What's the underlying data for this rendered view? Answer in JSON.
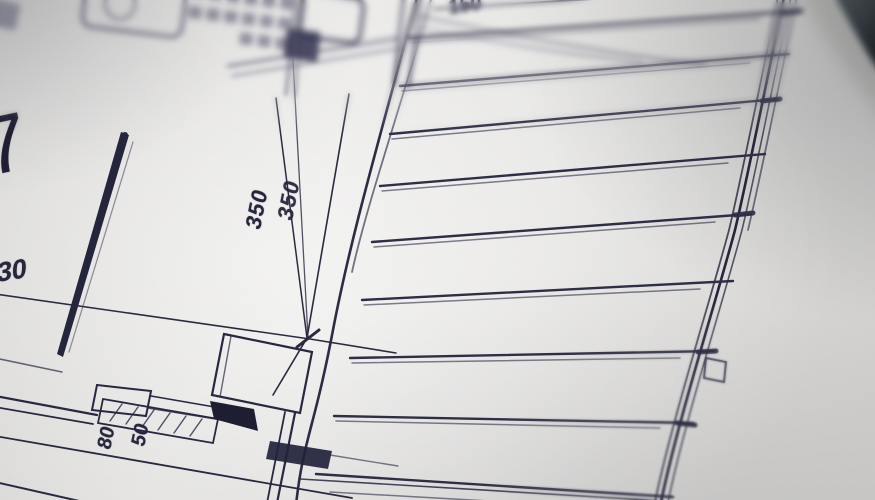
{
  "photo": {
    "subject": "architectural floor plan close-up",
    "colors": {
      "paper": "#e7e6e4",
      "ink": "#26263c",
      "ink_soft": "#3b3b55",
      "dark_object": "#1a1e22"
    }
  },
  "plan_labels": {
    "room_number": "7",
    "dim_350_a": "350",
    "dim_350_b": "350",
    "dim_30": "30",
    "dim_150": "150",
    "dim_80": "80",
    "dim_50": "50"
  }
}
